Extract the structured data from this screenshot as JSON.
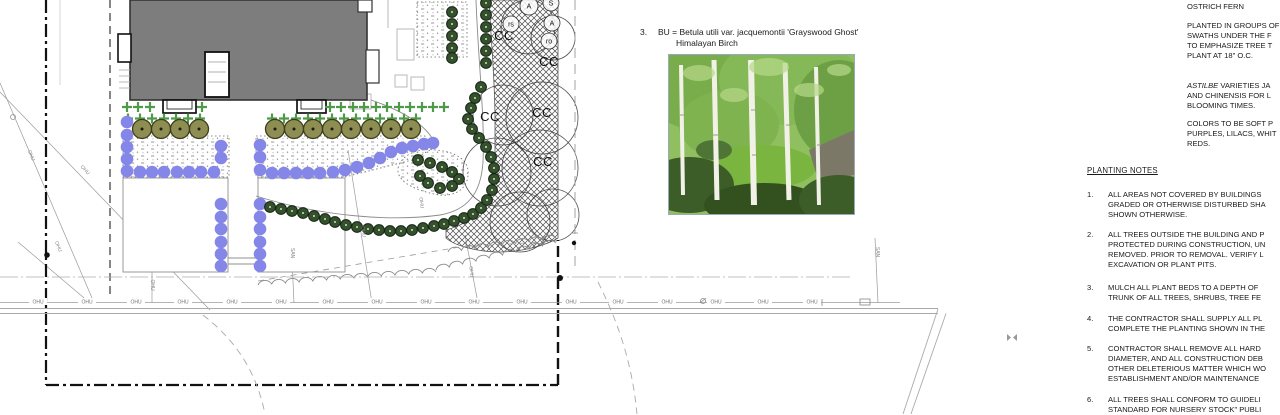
{
  "colors": {
    "purple": "#8486e8",
    "olive": "#8e8e52",
    "olive_stroke": "#3c3c1e",
    "green_shrub": "#35502c",
    "green_shrub_stroke": "#132512",
    "cross_green": "#4f9a48",
    "building_gray": "#7d7d7d",
    "hatch": "#4a4a4a",
    "line_light": "#a8a8a8",
    "text": "#1a1a1a"
  },
  "legend": {
    "number": "3.",
    "code_line": "BU = Betula utili var. jacquemontii 'Grayswood Ghost'",
    "common_name": "Himalayan Birch"
  },
  "right_column": {
    "fern_heading": "OSTRICH FERN",
    "paragraphs": [
      {
        "top": 21,
        "lines": [
          "PLANTED IN GROUPS OF",
          "SWATHS UNDER THE F",
          "TO EMPHASIZE TREE T",
          "PLANT AT 18\" O.C."
        ]
      },
      {
        "top": 81,
        "italic_lead": "ASTILBE",
        "lines": [
          "VARIETIES JA",
          "AND CHINENSIS FOR L",
          "BLOOMING TIMES."
        ]
      },
      {
        "top": 119,
        "lines": [
          "COLORS TO BE SOFT P",
          "PURPLES, LILACS, WHIT",
          "REDS."
        ]
      }
    ]
  },
  "planting_notes": {
    "heading": "PLANTING NOTES",
    "items": [
      {
        "top": 190,
        "num": "1.",
        "lines": [
          "ALL AREAS NOT COVERED BY BUILDINGS",
          "GRADED OR OTHERWISE DISTURBED SHA",
          "SHOWN OTHERWISE."
        ]
      },
      {
        "top": 230,
        "num": "2.",
        "lines": [
          "ALL TREES OUTSIDE THE BUILDING AND P",
          "PROTECTED DURING CONSTRUCTION, UN",
          "REMOVED. PRIOR TO REMOVAL. VERIFY L",
          "EXCAVATION OR PLANT PITS."
        ]
      },
      {
        "top": 283,
        "num": "3.",
        "lines": [
          "MULCH ALL PLANT BEDS TO A DEPTH OF",
          "TRUNK OF ALL TREES, SHRUBS, TREE FE"
        ]
      },
      {
        "top": 314,
        "num": "4.",
        "lines": [
          "THE CONTRACTOR SHALL SUPPLY ALL PL",
          "COMPLETE THE PLANTING SHOWN IN THE"
        ]
      },
      {
        "top": 344,
        "num": "5.",
        "lines": [
          "CONTRACTOR SHALL REMOVE ALL HARD",
          "DIAMETER, AND  ALL CONSTRUCTION DEB",
          "OTHER DELETERIOUS MATTER WHICH WO",
          "ESTABLISHMENT AND/OR MAINTENANCE"
        ]
      },
      {
        "top": 395,
        "num": "6.",
        "lines": [
          "ALL TREES SHALL CONFORM TO GUIDELI",
          "STANDARD FOR NURSERY STOCK\" PUBLI"
        ]
      }
    ]
  },
  "plan": {
    "tree_labels": [
      {
        "t": "CC",
        "x": 504,
        "y": 40
      },
      {
        "t": "CC",
        "x": 549,
        "y": 66
      },
      {
        "t": "CC",
        "x": 490,
        "y": 121
      },
      {
        "t": "CC",
        "x": 542,
        "y": 117
      },
      {
        "t": "CC",
        "x": 543,
        "y": 166
      }
    ],
    "tree_tags": [
      {
        "t": "A",
        "x": 529,
        "y": 6,
        "r": 9
      },
      {
        "t": "S",
        "x": 551,
        "y": 3,
        "r": 8
      },
      {
        "t": "A",
        "x": 552,
        "y": 23,
        "r": 8
      },
      {
        "t": "ro",
        "x": 549,
        "y": 41,
        "r": 8
      },
      {
        "t": "rs",
        "x": 511,
        "y": 24,
        "r": 8
      }
    ],
    "canopy_circles": [
      [
        528,
        27,
        27
      ],
      [
        553,
        38,
        22
      ],
      [
        503,
        115,
        30
      ],
      [
        542,
        118,
        36
      ],
      [
        497,
        172,
        34
      ],
      [
        540,
        168,
        38
      ],
      [
        520,
        222,
        30
      ],
      [
        553,
        215,
        26
      ]
    ],
    "utility": {
      "ohu_text": "OHU",
      "ohu_y": 302,
      "ohu_x": [
        38,
        87,
        136,
        183,
        232,
        281,
        328,
        377,
        426,
        474,
        522,
        571,
        618,
        667,
        716,
        763,
        812
      ],
      "rotated_labels": [
        {
          "t": "OHU",
          "x": 30,
          "y": 156,
          "r": 68
        },
        {
          "t": "OHU",
          "x": 57,
          "y": 247,
          "r": 68
        },
        {
          "t": "OHU",
          "x": 84,
          "y": 171,
          "r": 46
        },
        {
          "t": "OHU",
          "x": 151,
          "y": 285,
          "r": 90
        },
        {
          "t": "OHU",
          "x": 362,
          "y": 232,
          "r": 82
        },
        {
          "t": "OHU",
          "x": 470,
          "y": 272,
          "r": 84
        },
        {
          "t": "OHU",
          "x": 420,
          "y": 203,
          "r": 84
        },
        {
          "t": "SAN",
          "x": 291,
          "y": 253,
          "r": 90
        },
        {
          "t": "SAN",
          "x": 876,
          "y": 252,
          "r": 90
        }
      ]
    },
    "symbols": {
      "birch_row_y": 129,
      "birch_trees_x": [
        142,
        161,
        180,
        199,
        275,
        294,
        313,
        332,
        351,
        371,
        391,
        411
      ],
      "crosses_row1_y": 107,
      "crosses_row1_x": [
        127,
        138,
        150,
        202,
        330,
        341,
        353,
        364,
        376,
        387,
        399,
        410,
        422,
        433,
        444
      ],
      "crosses_row2_y": 118.5,
      "crosses_row2_x": [
        128,
        140,
        152,
        164,
        176,
        188,
        200,
        272,
        284,
        296,
        308,
        320,
        332,
        344,
        356,
        368,
        380,
        392,
        404,
        416
      ],
      "purple_shrubs": [
        [
          127,
          122
        ],
        [
          127,
          135
        ],
        [
          127,
          147
        ],
        [
          127,
          159
        ],
        [
          127,
          171
        ],
        [
          140,
          172
        ],
        [
          152,
          172
        ],
        [
          164,
          172
        ],
        [
          177,
          172
        ],
        [
          189,
          172
        ],
        [
          201,
          172
        ],
        [
          214,
          172
        ],
        [
          221,
          146
        ],
        [
          221,
          158
        ],
        [
          221,
          204
        ],
        [
          221,
          217
        ],
        [
          221,
          229
        ],
        [
          221,
          242
        ],
        [
          221,
          254
        ],
        [
          221,
          266
        ],
        [
          260,
          145
        ],
        [
          260,
          157
        ],
        [
          260,
          170
        ],
        [
          260,
          204
        ],
        [
          260,
          217
        ],
        [
          260,
          229
        ],
        [
          260,
          242
        ],
        [
          260,
          254
        ],
        [
          260,
          266
        ],
        [
          272,
          173
        ],
        [
          284,
          173
        ],
        [
          296,
          173
        ],
        [
          308,
          173
        ],
        [
          320,
          173
        ],
        [
          333,
          172
        ],
        [
          345,
          170
        ],
        [
          357,
          167
        ],
        [
          369,
          163
        ],
        [
          380,
          158
        ],
        [
          391,
          152
        ],
        [
          402,
          148
        ],
        [
          413,
          146
        ],
        [
          424,
          144
        ],
        [
          433,
          143
        ]
      ],
      "green_shrubs": [
        [
          270,
          207
        ],
        [
          281,
          209
        ],
        [
          292,
          211
        ],
        [
          303,
          213
        ],
        [
          314,
          216
        ],
        [
          325,
          219
        ],
        [
          335,
          222
        ],
        [
          346,
          225
        ],
        [
          357,
          227
        ],
        [
          368,
          229
        ],
        [
          379,
          230
        ],
        [
          390,
          231
        ],
        [
          401,
          231
        ],
        [
          412,
          230
        ],
        [
          423,
          228
        ],
        [
          434,
          226
        ],
        [
          444,
          224
        ],
        [
          454,
          221
        ],
        [
          464,
          218
        ],
        [
          473,
          214
        ],
        [
          481,
          208
        ],
        [
          487,
          200
        ],
        [
          492,
          190
        ],
        [
          494,
          179
        ],
        [
          494,
          168
        ],
        [
          491,
          157
        ],
        [
          486,
          147
        ],
        [
          479,
          138
        ],
        [
          472,
          129
        ],
        [
          468,
          119
        ],
        [
          471,
          108
        ],
        [
          475,
          98
        ],
        [
          481,
          87
        ],
        [
          452,
          12
        ],
        [
          452,
          24
        ],
        [
          452,
          36
        ],
        [
          452,
          48
        ],
        [
          452,
          58
        ],
        [
          486,
          3
        ],
        [
          486,
          15
        ],
        [
          486,
          27
        ],
        [
          486,
          39
        ],
        [
          486,
          51
        ],
        [
          486,
          63
        ],
        [
          418,
          160
        ],
        [
          430,
          163
        ],
        [
          442,
          167
        ],
        [
          452,
          172
        ],
        [
          459,
          179
        ],
        [
          452,
          186
        ],
        [
          440,
          188
        ],
        [
          428,
          183
        ],
        [
          420,
          176
        ]
      ]
    }
  }
}
